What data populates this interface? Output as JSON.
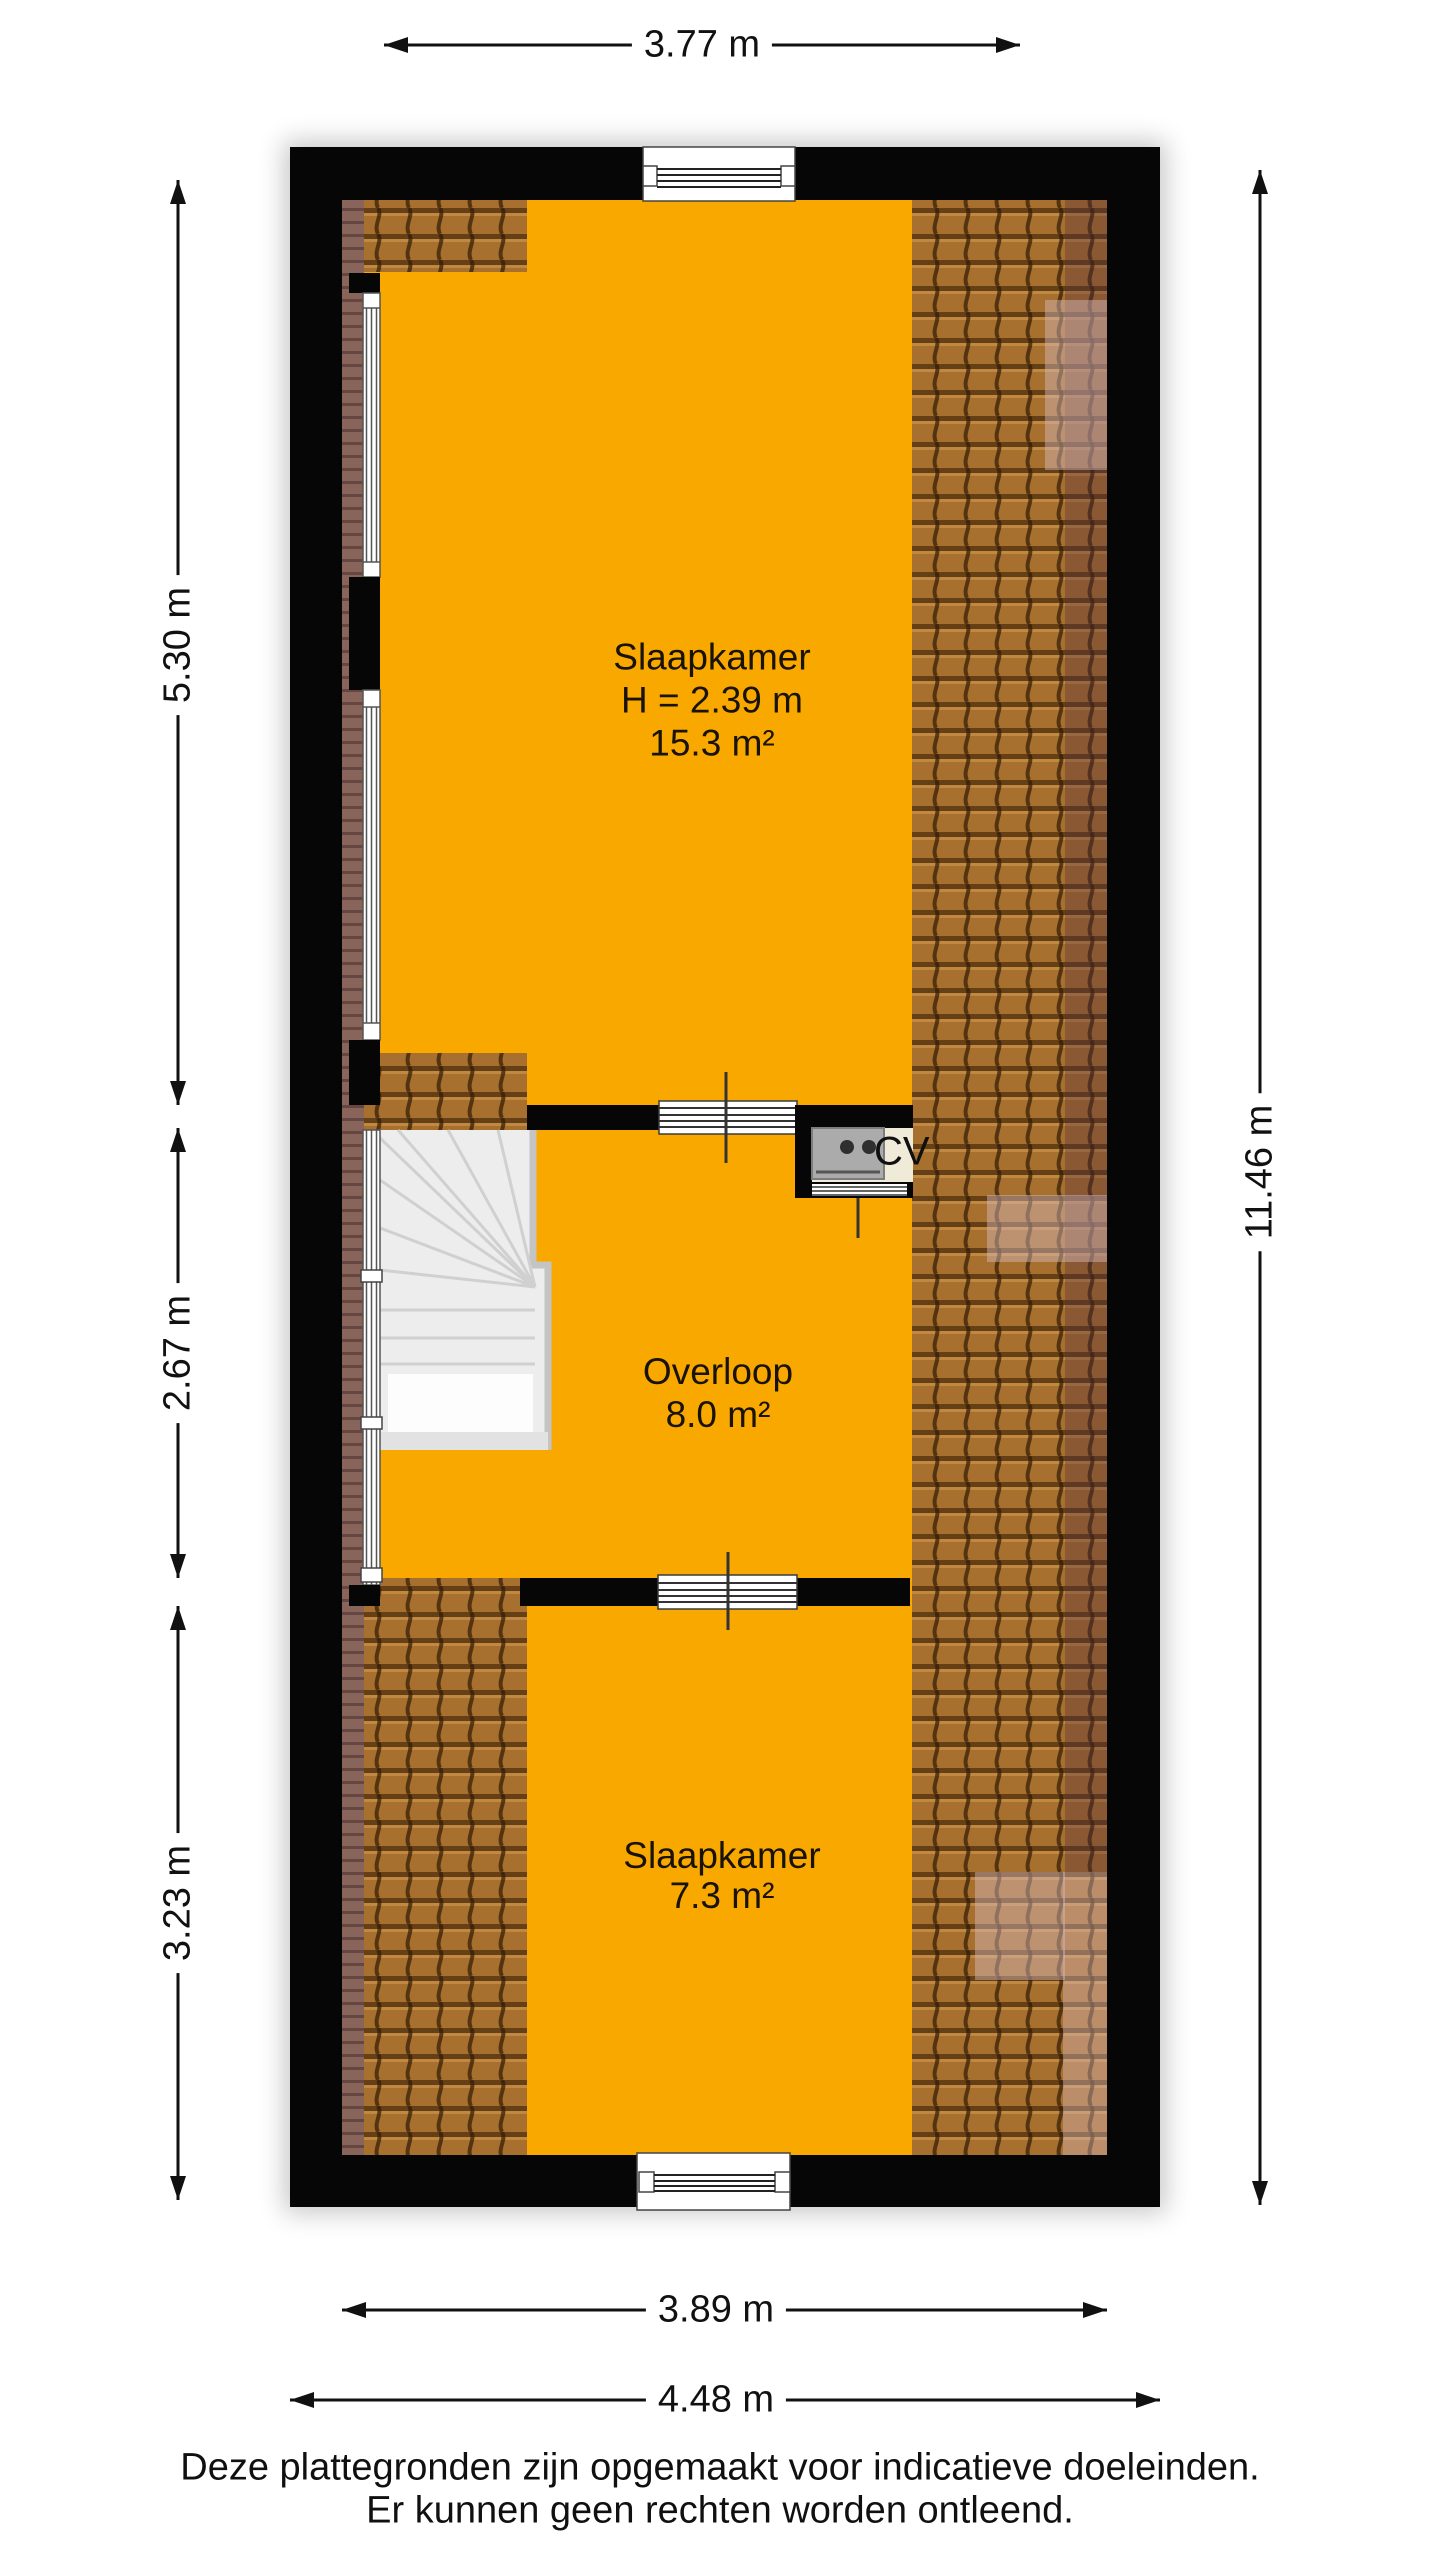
{
  "floorplan": {
    "rooms": [
      {
        "name": "Slaapkamer",
        "ceiling": "H = 2.39 m",
        "area": "15.3 m²"
      },
      {
        "name": "Overloop",
        "area": "8.0 m²"
      },
      {
        "name": "Slaapkamer",
        "area": "7.3 m²"
      }
    ],
    "cv_label": "CV",
    "dimensions": {
      "top": "3.77 m",
      "left": [
        "5.30 m",
        "2.67 m",
        "3.23 m"
      ],
      "right": "11.46 m",
      "bottom": [
        "3.89 m",
        "4.48 m"
      ]
    },
    "footer": {
      "line1": "Deze plattegronden zijn opgemaakt voor indicatieve doeleinden.",
      "line2": "Er kunnen geen rechten worden ontleend."
    }
  },
  "colors": {
    "floor": "#F9A800",
    "wall": "#060606",
    "tile": "#A8702F",
    "dim_text": "#111111"
  }
}
